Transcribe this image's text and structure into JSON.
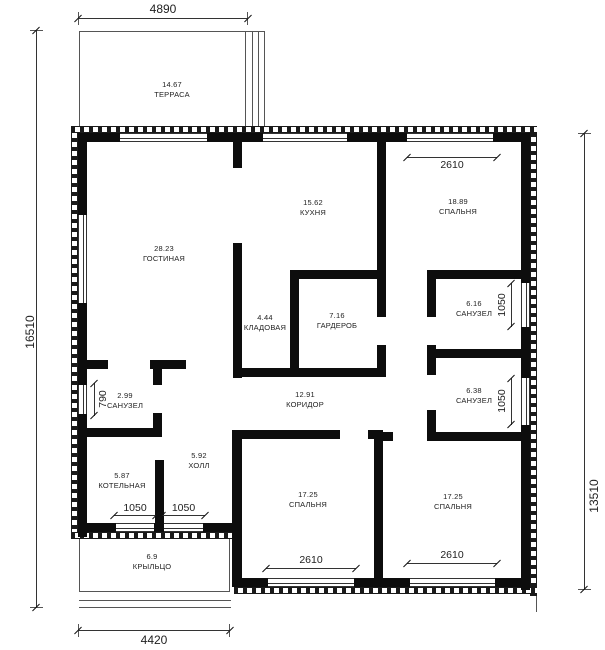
{
  "drawing": {
    "type": "architectural floor plan",
    "language": "ru"
  },
  "rooms": [
    {
      "id": "terrace",
      "area": "14.67",
      "name": "ТЕРРАСА"
    },
    {
      "id": "living-room",
      "area": "28.23",
      "name": "ГОСТИНАЯ"
    },
    {
      "id": "kitchen",
      "area": "15.62",
      "name": "КУХНЯ"
    },
    {
      "id": "bedroom-top",
      "area": "18.89",
      "name": "СПАЛЬНЯ"
    },
    {
      "id": "pantry",
      "area": "4.44",
      "name": "КЛАДОВАЯ"
    },
    {
      "id": "wardrobe",
      "area": "7.16",
      "name": "ГАРДЕРОБ"
    },
    {
      "id": "bathroom-1",
      "area": "6.16",
      "name": "САНУЗЕЛ"
    },
    {
      "id": "corridor",
      "area": "12.91",
      "name": "КОРИДОР"
    },
    {
      "id": "bathroom-2",
      "area": "2.99",
      "name": "САНУЗЕЛ"
    },
    {
      "id": "bathroom-3",
      "area": "6.38",
      "name": "САНУЗЕЛ"
    },
    {
      "id": "hall",
      "area": "5.92",
      "name": "ХОЛЛ"
    },
    {
      "id": "boiler-room",
      "area": "5.87",
      "name": "КОТЕЛЬНАЯ"
    },
    {
      "id": "bedroom-bl",
      "area": "17.25",
      "name": "СПАЛЬНЯ"
    },
    {
      "id": "bedroom-br",
      "area": "17.25",
      "name": "СПАЛЬНЯ"
    },
    {
      "id": "porch",
      "area": "6.9",
      "name": "КРЫЛЬЦО"
    }
  ],
  "dimensions": {
    "overall": {
      "top": "4890",
      "left": "16510",
      "right": "13510",
      "bottom": "4420"
    },
    "openings": {
      "bedroom_top_window": "2610",
      "bath1_window": "1050",
      "bath2_window": "790",
      "bath3_window": "1050",
      "boiler_window": "1050",
      "hall_window": "1050",
      "bedroom_bl_window": "2610",
      "bedroom_br_window": "2610"
    }
  },
  "colors": {
    "wall": "#0d0d0d",
    "line": "#555555",
    "background": "#ffffff"
  }
}
